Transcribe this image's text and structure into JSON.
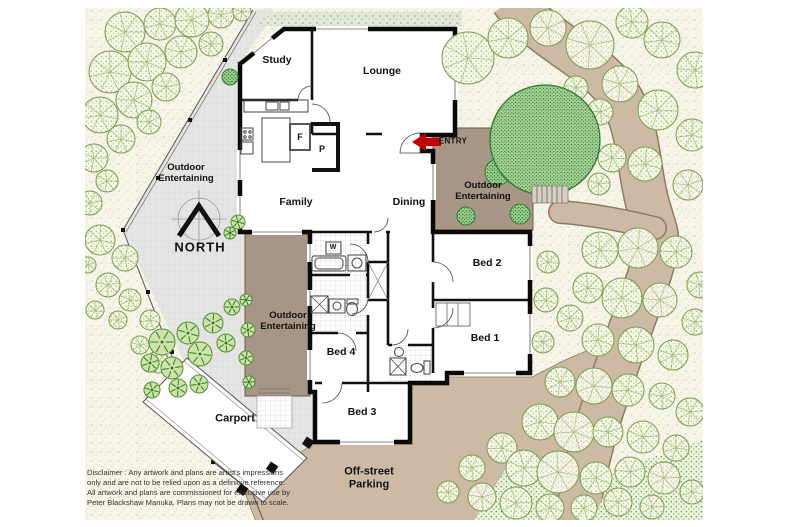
{
  "labels": {
    "study": "Study",
    "lounge": "Lounge",
    "family": "Family",
    "dining": "Dining",
    "bed1": "Bed 1",
    "bed2": "Bed 2",
    "bed3": "Bed 3",
    "bed4": "Bed 4",
    "entry": "ENTRY",
    "north": "NORTH",
    "outdoor_entertaining_paved": "Outdoor Entertaining",
    "outdoor_entertaining_rear_deck": "Outdoor Entertaining",
    "outdoor_entertaining_side_deck": "Outdoor Entertaining",
    "carport": "Carport",
    "off_street_parking": "Off-street Parking",
    "fridge": "F",
    "pantry": "P",
    "washer": "W"
  },
  "disclaimer": "Disclaimer : Any artwork and plans are artist's impressions only and are not to be relied upon as a definitive reference. All artwork and plans are commissioned for exclusive use by Peter Blackshaw Manuka. Plans may not be drawn to scale.",
  "colors": {
    "wall": "#111111",
    "deck": "#a79685",
    "path": "#cdbaa5",
    "paving": "#e5e5e3",
    "ground": "#f7f4e8",
    "tree_outline": "#7a9a4e",
    "dense_tree": "#2a7d2a",
    "entry_arrow": "#c40000"
  }
}
